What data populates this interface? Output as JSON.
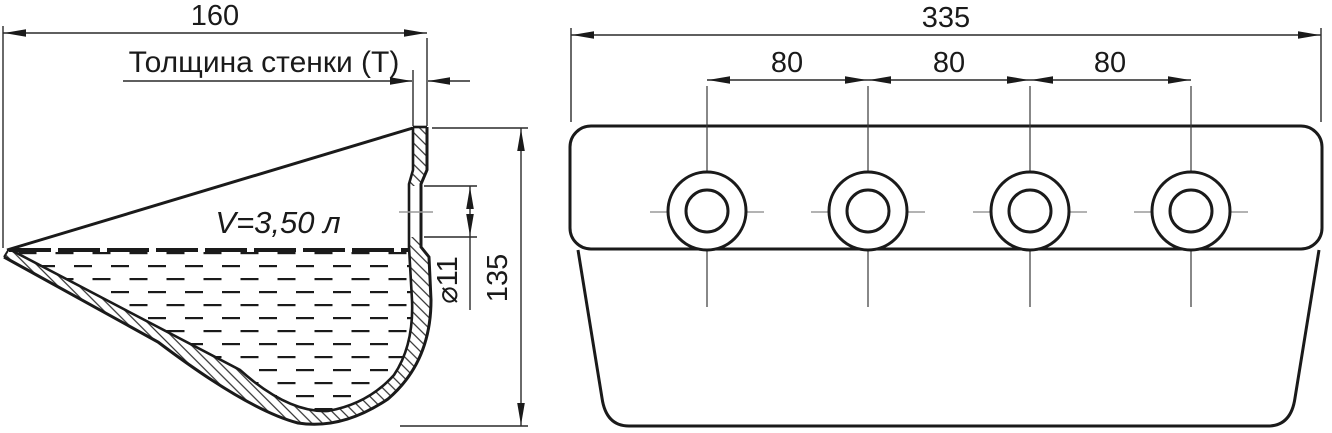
{
  "side_view": {
    "width_dim": "160",
    "wall_thickness_label": "Толщина стенки (Т)",
    "volume_label": "V=3,50 л",
    "hole_diameter_dim": "⌀11",
    "height_dim": "135"
  },
  "front_view": {
    "width_dim": "335",
    "hole_spacing_dims": [
      "80",
      "80",
      "80"
    ],
    "hole_count": 4
  },
  "colors": {
    "background": "#ffffff",
    "outline": "#1a1a1a",
    "dimension": "#2a2a2a",
    "centerline": "#9a9a9a"
  }
}
